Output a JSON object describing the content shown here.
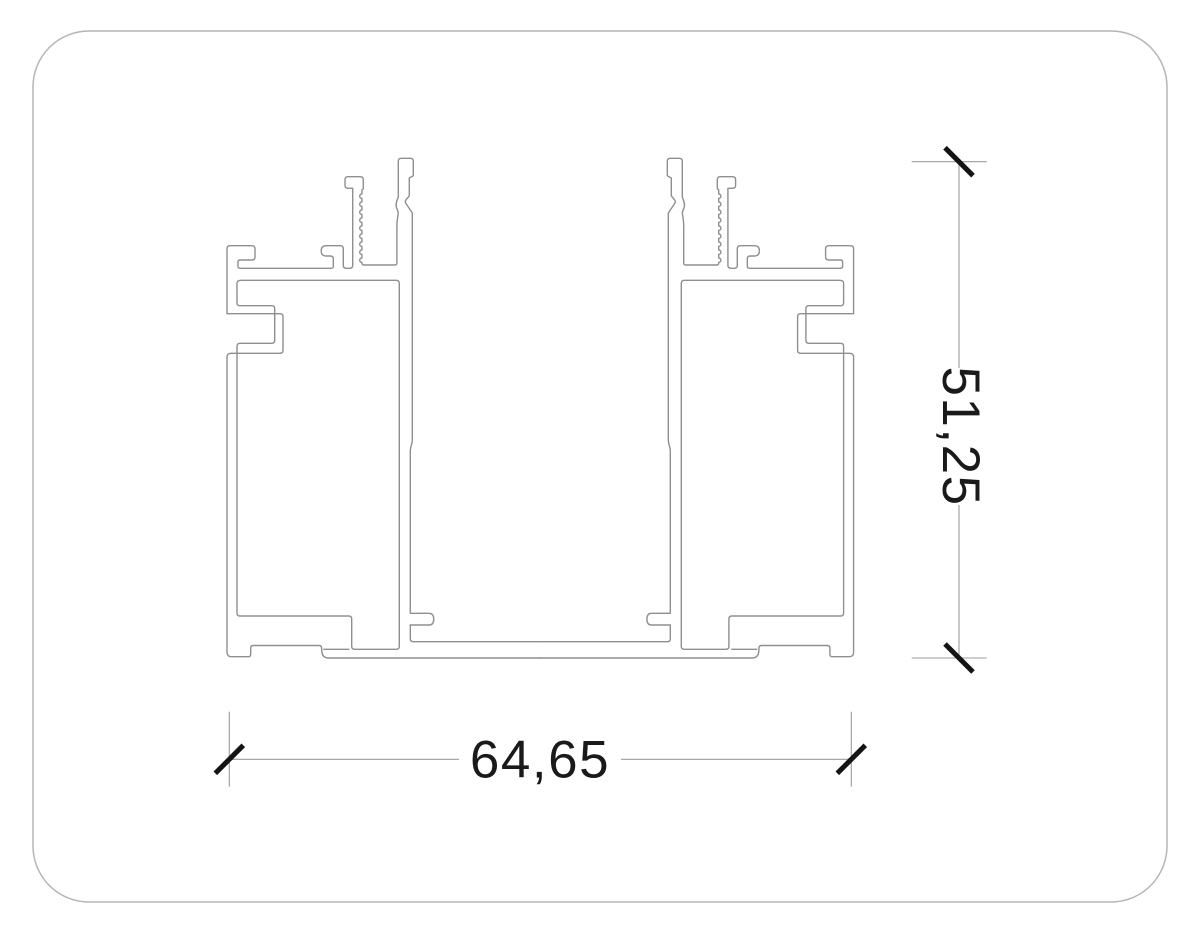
{
  "drawing": {
    "type_label": "profile-cross-section",
    "dimensions": {
      "width": {
        "label": "64,65"
      },
      "height": {
        "label": "51,25"
      }
    },
    "colors": {
      "background": "#ffffff",
      "outline": "#8f8f8f",
      "dimension_line": "#9c9c9c",
      "tick": "#141414",
      "label_text": "#1a1a1a",
      "page_border": "#b5b5b5"
    }
  }
}
